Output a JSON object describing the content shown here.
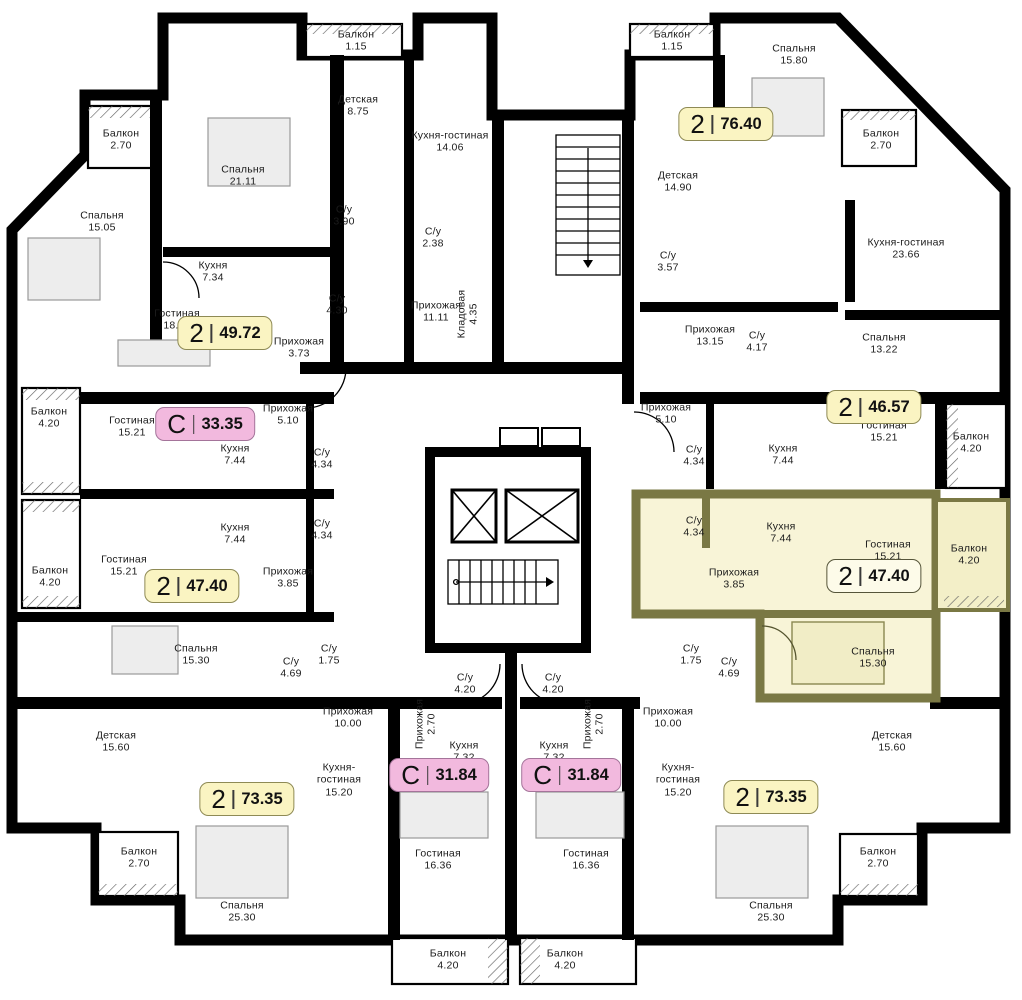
{
  "colors": {
    "wall": "#000000",
    "floor": "#ffffff",
    "highlight_fill": "#f8f4d5",
    "highlight_wall": "#7a7844",
    "badge_yellow": "#faf4c2",
    "badge_pink": "#f2b9de",
    "badge_selected": "#fdfbe9"
  },
  "selected_apartment": {
    "type": "2",
    "area": "47.40"
  },
  "badges": [
    {
      "type": "2",
      "area": "49.72",
      "style": "yellow"
    },
    {
      "type": "С",
      "area": "33.35",
      "style": "pink"
    },
    {
      "type": "2",
      "area": "47.40",
      "style": "yellow"
    },
    {
      "type": "2",
      "area": "76.40",
      "style": "yellow"
    },
    {
      "type": "2",
      "area": "46.57",
      "style": "yellow"
    },
    {
      "type": "2",
      "area": "47.40",
      "style": "yellow",
      "selected": true
    },
    {
      "type": "С",
      "area": "31.84",
      "style": "pink"
    },
    {
      "type": "С",
      "area": "31.84",
      "style": "pink"
    },
    {
      "type": "2",
      "area": "73.35",
      "style": "yellow"
    },
    {
      "type": "2",
      "area": "73.35",
      "style": "yellow"
    }
  ],
  "rooms": [
    {
      "name": "Балкон",
      "area": "2.70"
    },
    {
      "name": "Спальня",
      "area": "21.11"
    },
    {
      "name": "Спальня",
      "area": "15.05"
    },
    {
      "name": "Кухня",
      "area": "7.34"
    },
    {
      "name": "Гостиная",
      "area": "18.49"
    },
    {
      "name": "Прихожая",
      "area": "3.73"
    },
    {
      "name": "С/у",
      "area": "3.90"
    },
    {
      "name": "С/у",
      "area": "4.30"
    },
    {
      "name": "Балкон",
      "area": "1.15"
    },
    {
      "name": "Детская",
      "area": "8.75"
    },
    {
      "name": "Кухня-гостиная",
      "area": "14.06"
    },
    {
      "name": "С/у",
      "area": "2.38"
    },
    {
      "name": "Прихожая",
      "area": "11.11"
    },
    {
      "name": "Кладовая",
      "area": "4.35"
    },
    {
      "name": "Балкон",
      "area": "1.15"
    },
    {
      "name": "Спальня",
      "area": "15.80"
    },
    {
      "name": "Балкон",
      "area": "2.70"
    },
    {
      "name": "Детская",
      "area": "14.90"
    },
    {
      "name": "С/у",
      "area": "3.57"
    },
    {
      "name": "Кухня-гостиная",
      "area": "23.66"
    },
    {
      "name": "Прихожая",
      "area": "13.15"
    },
    {
      "name": "С/у",
      "area": "4.17"
    },
    {
      "name": "Спальня",
      "area": "13.22"
    },
    {
      "name": "Прихожая",
      "area": "5.10"
    },
    {
      "name": "С/у",
      "area": "4.34"
    },
    {
      "name": "Кухня",
      "area": "7.44"
    },
    {
      "name": "Гостиная",
      "area": "15.21"
    },
    {
      "name": "Балкон",
      "area": "4.20"
    },
    {
      "name": "С/у",
      "area": "4.34"
    },
    {
      "name": "Кухня",
      "area": "7.44"
    },
    {
      "name": "Гостиная",
      "area": "15.21"
    },
    {
      "name": "Прихожая",
      "area": "3.85"
    },
    {
      "name": "Балкон",
      "area": "4.20"
    },
    {
      "name": "Спальня",
      "area": "15.30"
    },
    {
      "name": "С/у",
      "area": "1.75"
    },
    {
      "name": "С/у",
      "area": "4.69"
    },
    {
      "name": "Прихожая",
      "area": "10.00"
    },
    {
      "name": "Кухня-гостиная",
      "area": "15.20"
    },
    {
      "name": "Балкон",
      "area": "4.20"
    },
    {
      "name": "Гостиная",
      "area": "15.21"
    },
    {
      "name": "Прихожая",
      "area": "5.10"
    },
    {
      "name": "Кухня",
      "area": "7.44"
    },
    {
      "name": "С/у",
      "area": "4.34"
    },
    {
      "name": "Балкон",
      "area": "4.20"
    },
    {
      "name": "Гостиная",
      "area": "15.21"
    },
    {
      "name": "Кухня",
      "area": "7.44"
    },
    {
      "name": "С/у",
      "area": "4.34"
    },
    {
      "name": "Прихожая",
      "area": "3.85"
    },
    {
      "name": "Спальня",
      "area": "15.30"
    },
    {
      "name": "С/у",
      "area": "4.69"
    },
    {
      "name": "С/у",
      "area": "1.75"
    },
    {
      "name": "Прихожая",
      "area": "10.00"
    },
    {
      "name": "Кухня-гостиная",
      "area": "15.20"
    },
    {
      "name": "Детская",
      "area": "15.60"
    },
    {
      "name": "Балкон",
      "area": "2.70"
    },
    {
      "name": "Спальня",
      "area": "25.30"
    },
    {
      "name": "Гостиная",
      "area": "16.36"
    },
    {
      "name": "Балкон",
      "area": "4.20"
    },
    {
      "name": "С/у",
      "area": "4.20"
    },
    {
      "name": "Прихожая",
      "area": "2.70"
    },
    {
      "name": "Кухня",
      "area": "7.32"
    },
    {
      "name": "С/у",
      "area": "4.20"
    },
    {
      "name": "Прихожая",
      "area": "2.70"
    },
    {
      "name": "Кухня",
      "area": "7.32"
    },
    {
      "name": "Гостиная",
      "area": "16.36"
    },
    {
      "name": "Балкон",
      "area": "4.20"
    },
    {
      "name": "Детская",
      "area": "15.60"
    },
    {
      "name": "Спальня",
      "area": "25.30"
    },
    {
      "name": "Балкон",
      "area": "2.70"
    }
  ]
}
